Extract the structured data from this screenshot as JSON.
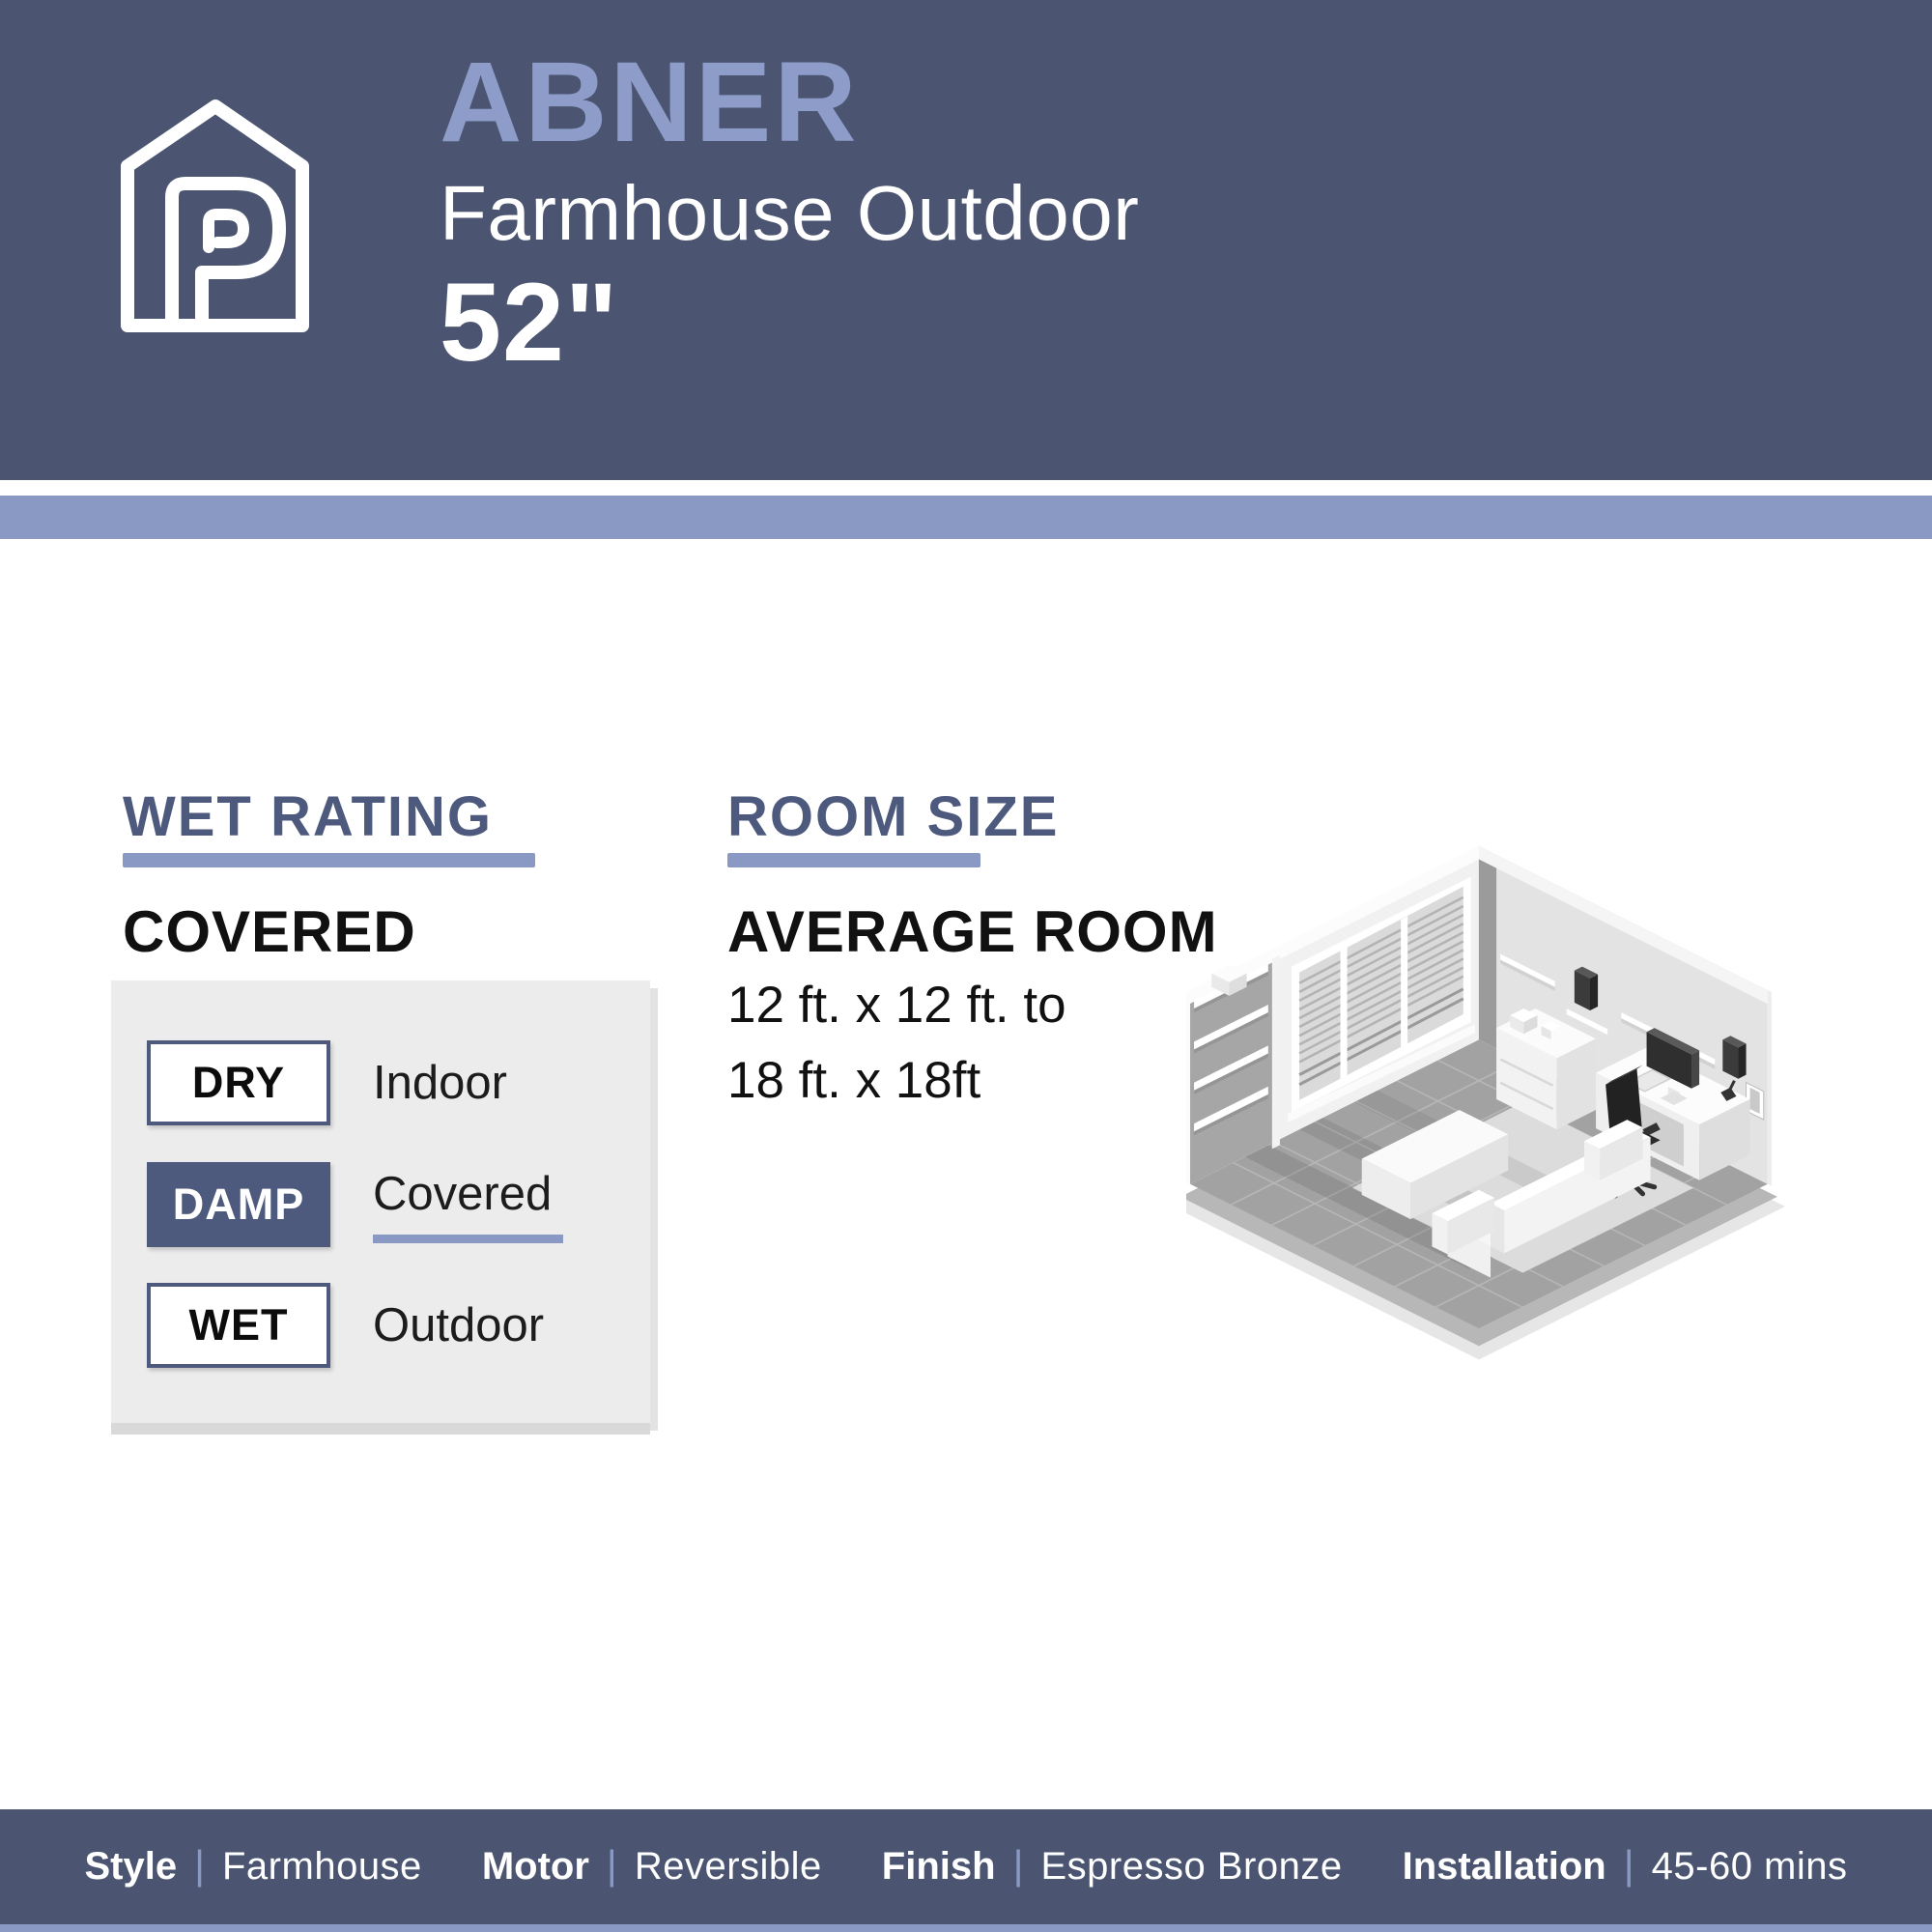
{
  "header": {
    "brand_icon": "house-p-logo",
    "title": "ABNER",
    "subtitle": "Farmhouse Outdoor",
    "size": "52\""
  },
  "colors": {
    "header_bg": "#4b5571",
    "accent_light": "#8a99c4",
    "title_text": "#8d9cc8",
    "heading_dark_blue": "#4d5a7d",
    "panel_bg": "#ececec"
  },
  "wet_rating": {
    "heading": "WET RATING",
    "value": "COVERED",
    "options": [
      {
        "badge": "DRY",
        "label": "Indoor",
        "selected": false
      },
      {
        "badge": "DAMP",
        "label": "Covered",
        "selected": true
      },
      {
        "badge": "WET",
        "label": "Outdoor",
        "selected": false
      }
    ]
  },
  "room_size": {
    "heading": "ROOM SIZE",
    "subheading": "AVERAGE ROOM",
    "range_line1": "12 ft. x 12 ft. to",
    "range_line2": "18 ft. x 18ft",
    "illustration_icon": "isometric-room-illustration"
  },
  "footer": {
    "separator": "|",
    "specs": [
      {
        "label": "Style",
        "value": "Farmhouse"
      },
      {
        "label": "Motor",
        "value": "Reversible"
      },
      {
        "label": "Finish",
        "value": "Espresso Bronze"
      },
      {
        "label": "Installation",
        "value": "45-60 mins"
      }
    ]
  }
}
